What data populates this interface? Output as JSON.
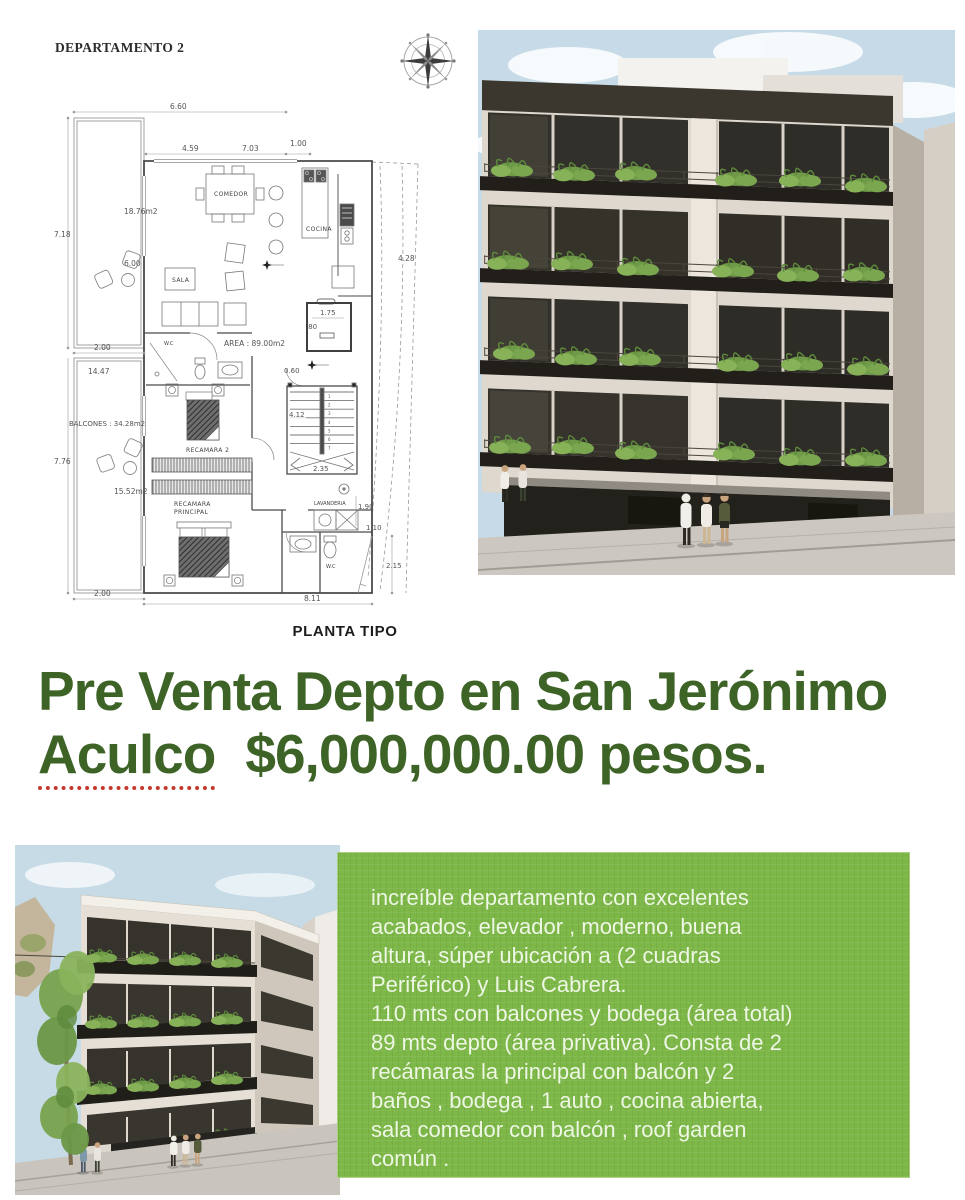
{
  "floorplan": {
    "title": "DEPARTAMENTO 2",
    "caption": "PLANTA TIPO",
    "area": "AREA : 89.00m2",
    "rooms": {
      "comedor": "COMEDOR",
      "cocina": "COCINA",
      "sala": "SALA",
      "wc1": "W.C",
      "wc2": "W.C",
      "rec2": "RECAMARA 2",
      "recp1": "RECAMARA",
      "recp2": "PRINCIPAL",
      "lav": "LAVANDERIA"
    },
    "balcony_labels": {
      "upper_area": "18.76m2",
      "balcones": "BALCONES : 34.28m2",
      "lower_area": "15.52m2"
    },
    "dims": {
      "d660": "6.60",
      "d459": "4.59",
      "d703": "7.03",
      "d100": "1.00",
      "d718": "7.18",
      "d600": "6.00",
      "d200a": "2.00",
      "d1447": "14.47",
      "d776": "7.76",
      "d200b": "2.00",
      "d811": "8.11",
      "d428": "4.28",
      "d175": "1.75",
      "d080": ".80",
      "d060": "0.60",
      "d412": "4.12",
      "d235": "2.35",
      "d190": "1.90",
      "d110": "1.10",
      "d215": "2.15"
    },
    "stairs": [
      "1",
      "2",
      "3",
      "4",
      "5",
      "6",
      "7"
    ]
  },
  "headline": {
    "line1": "Pre Venta Depto en San Jerónimo",
    "city": "Aculco",
    "price": "$6,000,000.00 pesos.",
    "color": "#3d6326"
  },
  "description": {
    "text": "increíble departamento con excelentes\nacabados,  elevador , moderno,  buena\naltura, súper ubicación a  (2 cuadras\nPeriférico) y Luis Cabrera.\n110 mts con balcones y bodega (área total)\n89 mts depto (área privativa). Consta de 2\nrecámaras la principal con balcón y 2\nbaños , bodega , 1 auto , cocina abierta,\nsala comedor con balcón , roof garden\ncomún .",
    "bg": "#7cb748",
    "text_color": "#eef6e4"
  }
}
